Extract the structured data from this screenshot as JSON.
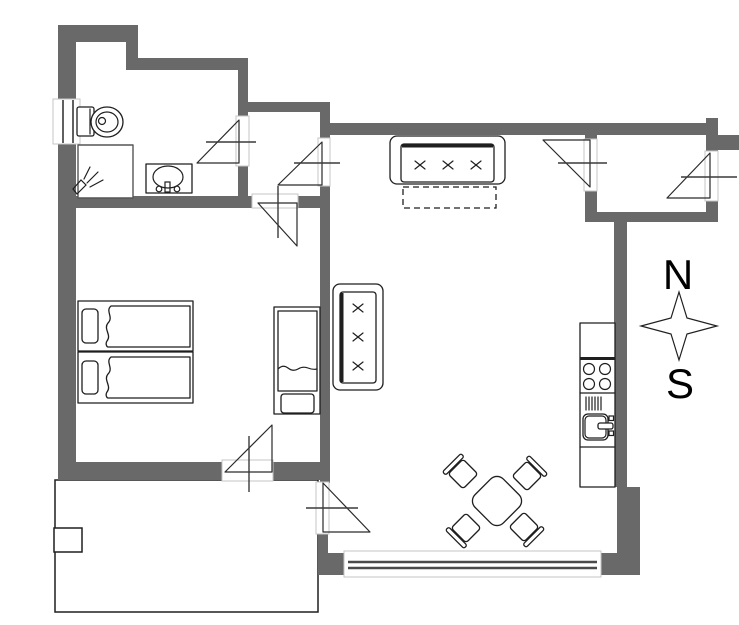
{
  "compass": {
    "north_label": "N",
    "south_label": "S"
  },
  "colors": {
    "wall": "#696969",
    "line": "#1f1f1f",
    "jamb": "#c6c6c6",
    "window": "#4a4a4a",
    "background": "#ffffff"
  },
  "symbols": {
    "bathroom": [
      "toilet",
      "washbasin",
      "shower"
    ],
    "bedroom": [
      "twin-bed",
      "twin-bed",
      "crib"
    ],
    "living_room": [
      "three-seat-sofa-bed",
      "two-seat-sofa",
      "dining-table",
      "dining-chair",
      "dining-chair",
      "dining-chair",
      "dining-chair"
    ],
    "kitchen": [
      "kitchen-counter",
      "four-burner-stove",
      "kitchen-sink"
    ],
    "outdoor": [
      "terrace",
      "terrace-step"
    ],
    "doors": [
      "bathroom-door",
      "hall-living-door",
      "bedroom-door",
      "bedroom-terrace-door",
      "living-terrace-door",
      "entry-living-door",
      "entrance-door"
    ],
    "windows": [
      "west-window",
      "south-window"
    ]
  }
}
